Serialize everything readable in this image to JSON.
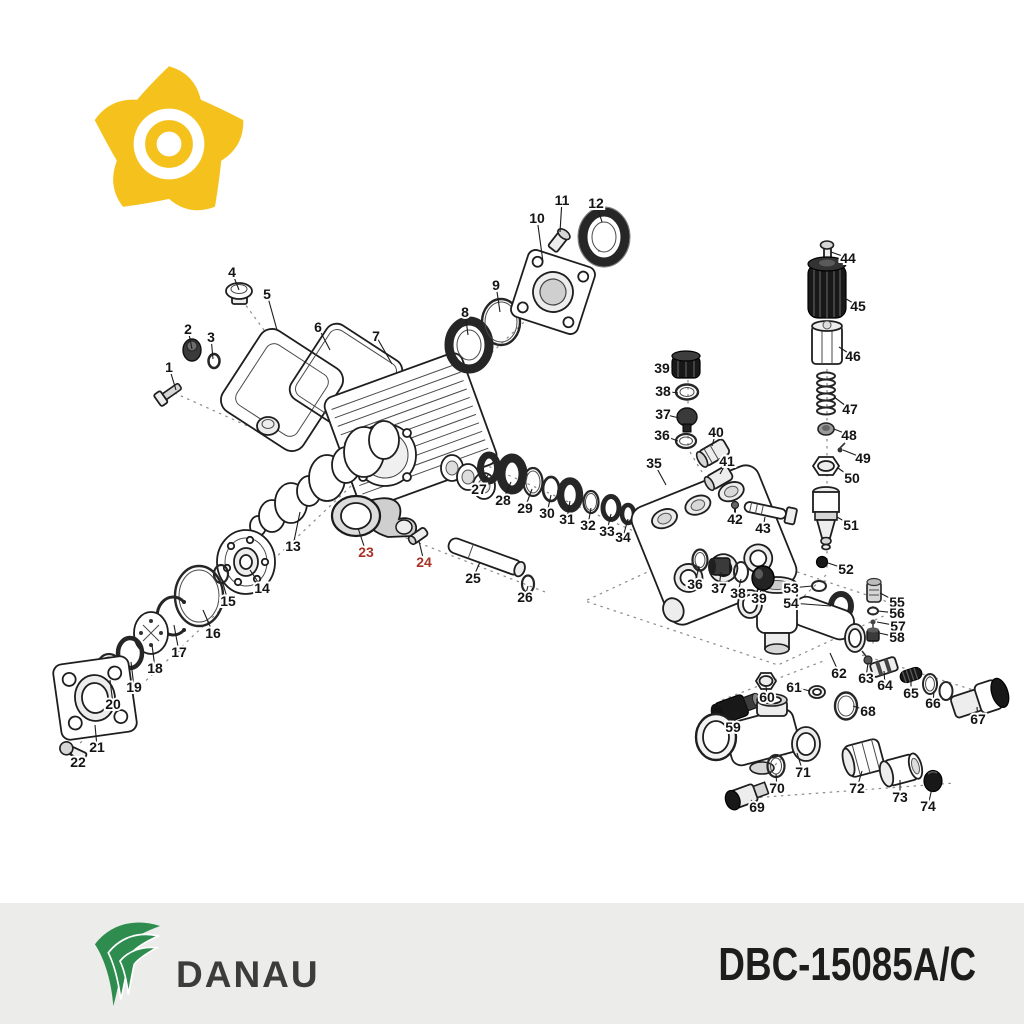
{
  "header": {
    "logo": "pinwheel-gear-logo",
    "logo_color": "#F5C21D"
  },
  "footer": {
    "brand": "DANAU",
    "brand_color": "#2E8C4F",
    "brand_text_color": "#3C3C3C",
    "model": "DBC-15085A/C",
    "background": "#ECECEA"
  },
  "diagram": {
    "description": "Exploded parts diagram of pressure washer pump",
    "label_color": "#141414",
    "highlight_color": "#A93226",
    "highlighted_parts": [
      "23",
      "24"
    ],
    "parts": [
      {
        "n": "1",
        "label": [
          169,
          367
        ],
        "part": [
          176,
          390
        ]
      },
      {
        "n": "2",
        "label": [
          188,
          329
        ],
        "part": [
          192,
          349
        ]
      },
      {
        "n": "3",
        "label": [
          211,
          337
        ],
        "part": [
          213,
          359
        ]
      },
      {
        "n": "4",
        "label": [
          232,
          272
        ],
        "part": [
          239,
          290
        ]
      },
      {
        "n": "5",
        "label": [
          267,
          294
        ],
        "part": [
          277,
          330
        ]
      },
      {
        "n": "6",
        "label": [
          318,
          327
        ],
        "part": [
          330,
          350
        ]
      },
      {
        "n": "7",
        "label": [
          376,
          336
        ],
        "part": [
          392,
          364
        ]
      },
      {
        "n": "8",
        "label": [
          465,
          312
        ],
        "part": [
          468,
          335
        ]
      },
      {
        "n": "9",
        "label": [
          496,
          285
        ],
        "part": [
          500,
          312
        ]
      },
      {
        "n": "10",
        "label": [
          537,
          218
        ],
        "part": [
          543,
          262
        ]
      },
      {
        "n": "11",
        "label": [
          562,
          200
        ],
        "part": [
          560,
          232
        ]
      },
      {
        "n": "12",
        "label": [
          596,
          203
        ],
        "part": [
          602,
          222
        ]
      },
      {
        "n": "13",
        "label": [
          293,
          546
        ],
        "part": [
          300,
          512
        ]
      },
      {
        "n": "14",
        "label": [
          262,
          588
        ],
        "part": [
          250,
          570
        ]
      },
      {
        "n": "15",
        "label": [
          228,
          601
        ],
        "part": [
          222,
          580
        ]
      },
      {
        "n": "16",
        "label": [
          213,
          633
        ],
        "part": [
          203,
          610
        ]
      },
      {
        "n": "17",
        "label": [
          179,
          652
        ],
        "part": [
          174,
          625
        ]
      },
      {
        "n": "18",
        "label": [
          155,
          668
        ],
        "part": [
          152,
          645
        ]
      },
      {
        "n": "19",
        "label": [
          134,
          687
        ],
        "part": [
          131,
          662
        ]
      },
      {
        "n": "20",
        "label": [
          113,
          704
        ],
        "part": [
          110,
          680
        ]
      },
      {
        "n": "21",
        "label": [
          97,
          747
        ],
        "part": [
          95,
          725
        ]
      },
      {
        "n": "22",
        "label": [
          78,
          762
        ],
        "part": [
          70,
          752
        ]
      },
      {
        "n": "23",
        "label": [
          366,
          552
        ],
        "part": [
          358,
          528
        ],
        "highlight": true
      },
      {
        "n": "24",
        "label": [
          424,
          562
        ],
        "part": [
          419,
          541
        ],
        "highlight": true
      },
      {
        "n": "25",
        "label": [
          473,
          578
        ],
        "part": [
          480,
          562
        ]
      },
      {
        "n": "26",
        "label": [
          525,
          597
        ],
        "part": [
          528,
          586
        ]
      },
      {
        "n": "27",
        "label": [
          479,
          489
        ],
        "part": [
          488,
          475
        ]
      },
      {
        "n": "28",
        "label": [
          503,
          500
        ],
        "part": [
          511,
          482
        ]
      },
      {
        "n": "29",
        "label": [
          525,
          508
        ],
        "part": [
          532,
          489
        ]
      },
      {
        "n": "30",
        "label": [
          547,
          513
        ],
        "part": [
          551,
          495
        ]
      },
      {
        "n": "31",
        "label": [
          567,
          519
        ],
        "part": [
          570,
          501
        ]
      },
      {
        "n": "32",
        "label": [
          588,
          525
        ],
        "part": [
          591,
          508
        ]
      },
      {
        "n": "33",
        "label": [
          607,
          531
        ],
        "part": [
          611,
          514
        ]
      },
      {
        "n": "34",
        "label": [
          623,
          537
        ],
        "part": [
          628,
          519
        ]
      },
      {
        "n": "35",
        "label": [
          654,
          463
        ],
        "part": [
          666,
          485
        ]
      },
      {
        "n": "36",
        "label": [
          662,
          435
        ],
        "part": [
          678,
          441
        ]
      },
      {
        "n": "37",
        "label": [
          663,
          414
        ],
        "part": [
          679,
          418
        ]
      },
      {
        "n": "38",
        "label": [
          663,
          391
        ],
        "part": [
          678,
          393
        ]
      },
      {
        "n": "39",
        "label": [
          662,
          368
        ],
        "part": [
          674,
          367
        ]
      },
      {
        "n": "40",
        "label": [
          716,
          432
        ],
        "part": [
          712,
          446
        ]
      },
      {
        "n": "41",
        "label": [
          727,
          461
        ],
        "part": [
          720,
          474
        ]
      },
      {
        "n": "42",
        "label": [
          735,
          519
        ],
        "part": [
          735,
          509
        ]
      },
      {
        "n": "43",
        "label": [
          763,
          528
        ],
        "part": [
          765,
          517
        ]
      },
      {
        "n": "44",
        "label": [
          848,
          258
        ],
        "part": [
          831,
          252
        ]
      },
      {
        "n": "45",
        "label": [
          858,
          306
        ],
        "part": [
          843,
          297
        ]
      },
      {
        "n": "46",
        "label": [
          853,
          356
        ],
        "part": [
          839,
          347
        ]
      },
      {
        "n": "47",
        "label": [
          850,
          409
        ],
        "part": [
          834,
          397
        ]
      },
      {
        "n": "48",
        "label": [
          849,
          435
        ],
        "part": [
          834,
          429
        ]
      },
      {
        "n": "49",
        "label": [
          863,
          458
        ],
        "part": [
          843,
          450
        ]
      },
      {
        "n": "50",
        "label": [
          852,
          478
        ],
        "part": [
          838,
          468
        ]
      },
      {
        "n": "51",
        "label": [
          851,
          525
        ],
        "part": [
          837,
          517
        ]
      },
      {
        "n": "52",
        "label": [
          846,
          569
        ],
        "part": [
          828,
          563
        ]
      },
      {
        "n": "53",
        "label": [
          791,
          588
        ],
        "part": [
          812,
          586
        ]
      },
      {
        "n": "54",
        "label": [
          791,
          603
        ],
        "part": [
          831,
          606
        ]
      },
      {
        "n": "55",
        "label": [
          897,
          602
        ],
        "part": [
          880,
          593
        ]
      },
      {
        "n": "56",
        "label": [
          897,
          613
        ],
        "part": [
          878,
          611
        ]
      },
      {
        "n": "57",
        "label": [
          898,
          626
        ],
        "part": [
          877,
          622
        ]
      },
      {
        "n": "58",
        "label": [
          897,
          637
        ],
        "part": [
          879,
          633
        ]
      },
      {
        "n": "59",
        "label": [
          733,
          727
        ],
        "part": [
          737,
          714
        ]
      },
      {
        "n": "60",
        "label": [
          767,
          697
        ],
        "part": [
          766,
          686
        ]
      },
      {
        "n": "61",
        "label": [
          794,
          687
        ],
        "part": [
          810,
          691
        ]
      },
      {
        "n": "62",
        "label": [
          839,
          673
        ],
        "part": [
          830,
          653
        ]
      },
      {
        "n": "63",
        "label": [
          866,
          678
        ],
        "part": [
          868,
          663
        ]
      },
      {
        "n": "64",
        "label": [
          885,
          685
        ],
        "part": [
          884,
          671
        ]
      },
      {
        "n": "65",
        "label": [
          911,
          693
        ],
        "part": [
          911,
          680
        ]
      },
      {
        "n": "66",
        "label": [
          933,
          703
        ],
        "part": [
          934,
          691
        ]
      },
      {
        "n": "67",
        "label": [
          978,
          719
        ],
        "part": [
          977,
          707
        ]
      },
      {
        "n": "68",
        "label": [
          868,
          711
        ],
        "part": [
          853,
          706
        ]
      },
      {
        "n": "69",
        "label": [
          757,
          807
        ],
        "part": [
          751,
          800
        ]
      },
      {
        "n": "70",
        "label": [
          777,
          788
        ],
        "part": [
          776,
          774
        ]
      },
      {
        "n": "71",
        "label": [
          803,
          772
        ],
        "part": [
          797,
          753
        ]
      },
      {
        "n": "72",
        "label": [
          857,
          788
        ],
        "part": [
          862,
          771
        ]
      },
      {
        "n": "73",
        "label": [
          900,
          797
        ],
        "part": [
          900,
          780
        ]
      },
      {
        "n": "74",
        "label": [
          928,
          806
        ],
        "part": [
          932,
          788
        ]
      },
      {
        "n": "36",
        "label": [
          695,
          584
        ],
        "part": [
          699,
          566
        ]
      },
      {
        "n": "37",
        "label": [
          719,
          588
        ],
        "part": [
          721,
          572
        ]
      },
      {
        "n": "38",
        "label": [
          738,
          593
        ],
        "part": [
          741,
          579
        ]
      },
      {
        "n": "39",
        "label": [
          759,
          598
        ],
        "part": [
          762,
          586
        ]
      }
    ]
  }
}
